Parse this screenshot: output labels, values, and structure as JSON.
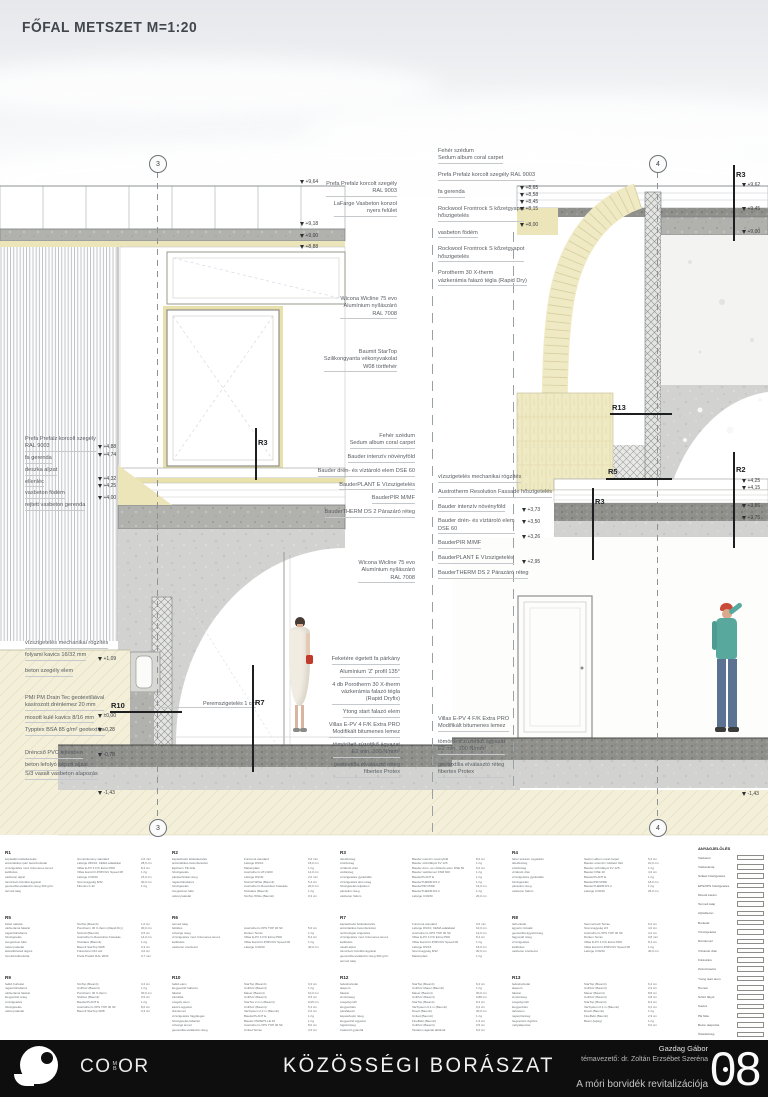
{
  "title": "FŐFAL METSZET M=1:20",
  "grid": {
    "left": "3",
    "right": "4"
  },
  "misc": {
    "perem": "Peremszigetelés 1 cm"
  },
  "rlabels": {
    "r2": "R2",
    "r3": "R3",
    "r5": "R5",
    "r7": "R7",
    "r10": "R10",
    "r13": "R13"
  },
  "elev": {
    "lt": [
      "+9,64",
      "+9,18",
      "+9,00",
      "+8,88"
    ],
    "lm": [
      "+4,88",
      "+4,74",
      "+4,32",
      "+4,25",
      "+4,00"
    ],
    "lb": [
      "+1,09",
      "±0,00",
      "-0,28",
      "-0,78",
      "-1,43"
    ],
    "gt": [
      "+8,65",
      "+8,58",
      "+8,45",
      "+8,15",
      "+8,00"
    ],
    "rm": [
      "+3,73",
      "+3,50",
      "+3,26",
      "+2,95"
    ],
    "re": [
      "+9,62",
      "+9,45",
      "+9,00",
      "+4,25",
      "+4,15",
      "+3,86",
      "+3,75",
      "-1,43"
    ]
  },
  "ann": {
    "gap_left_top": [
      "Prefa Prefalz korcolt szegély\nRAL 9003",
      "LaFarge Vasbeton konzol\nnyers felület"
    ],
    "gap_left_win": [
      "Wicona Wicline 75 evo\nAlumínium nyílászáró\nRAL 7008"
    ],
    "gap_left_vakolat": [
      "Baumit StarTop\nSzilikongyanta vékonyvakolat\nW08 törtfehér"
    ],
    "gap_right_top": [
      "Fehér szédum\nSedum album coral carpet",
      "Prefa Prefalz korcolt szegély RAL 9003",
      "fa gerenda",
      "Rockwool Frontrock S kőzetgyapot\nhőszigetelés",
      "vasbeton födém",
      "Rockwool Frontrock S kőzetgyapot\nhőszigetelés",
      "Porotherm 30 X-therm\nvázkerámia falazó tégla (Rapid Dry)"
    ],
    "gap_left_mid": [
      "Fehér szédum\nSedum album coral carpet",
      "Bauder intenzív növényföld",
      "Bauder drén- és víztároló elem DSE 60",
      "BauderPLANT E Vízszigetelés",
      "BauderPIR M/MF",
      "BauderTHERM DS 2 Párazáró réteg"
    ],
    "gap_left_window2": [
      "Wicona Wicline 75 evo\nAlumínium nyílászáró\nRAL 7008"
    ],
    "gap_right_mid": [
      "vízszigetelés mechanikai rögzítés",
      "Austrotherm Resolution Fassade hőszigetelés",
      "Bauder intenzív növényföld",
      "Bauder drén- és víztároló elem\nDSE 60",
      "BauderPIR M/MF",
      "BauderPLANT E Vízszigetelés",
      "BauderTHERM DS 2 Párazáró réteg"
    ],
    "left_mid": [
      "Prefa Prefalz korcolt szegély\nRAL 9003",
      "fa gerenda",
      "deszka aljzat",
      "ellenléc",
      "vasbeton födém",
      "rejtett vasbeton gerenda"
    ],
    "left_bottom_a": [
      "vízszigetelés mechanikai rögzítés",
      "folyami kavics 16/32 mm"
    ],
    "left_bottom_b": [
      "beton szegély elem"
    ],
    "left_bottom_c": [
      "PMI PM Drain Tec geotextíliával\nkasírozott drénlemez 20 mm",
      "mosott kulé kavics 8/16 mm",
      "Typptex BSA 85 g/m² geotextília"
    ],
    "left_bottom_d": [
      "Dréncső PVC lejtésben",
      "beton lefolyó képző aljzat"
    ],
    "left_bottom_e": [
      "S/3 vasalt vasbeton alapozás"
    ],
    "center_bottom": [
      "Feketére égetett fa párkány",
      "Alumínium 'Z' profil 135°",
      "4 db Porotherm 30 X-therm\nvázkerámia falazó tégla\n(Rapid Dryfix)",
      "Ytong start falazó elem",
      "Villas E-PV 4 F/K Extra PRO\nModifikált bitumenes lemez",
      "tömörített zúzottkő ágyazat\nE2 min. 100 N/mm²",
      "geotextília elválasztó réteg\nfibertex Protex"
    ],
    "right_bottom": [
      "Villas E-PV 4 F/K Extra PRO\nModifikált bitumenes lemez",
      "tömörített zúzottkő ágyazat\nE2 min. 100 N/mm²",
      "geotextília elválasztó réteg\nfibertex Protex"
    ]
  },
  "legend": {
    "blocks": [
      {
        "id": "R1",
        "rows": [
          [
            "kopásálló felületkezelés",
            "Gumiőrlemény standard",
            "2,0 mm"
          ],
          [
            "antisztatikus ipari betonburkolat",
            "Lafarge 250/10, KEMA adalékkal",
            "28,5 cm"
          ],
          [
            "vízszigetelés mod. bitumenes lemez",
            "Villas E-PV 4 F/K Extra PRO",
            "8,4 cm"
          ],
          [
            "kellősítés",
            "Villas EuroCO-P/MV/GV Speed 08",
            "1 rtg"
          ],
          [
            "vasbeton aljzat",
            "Lafarge C30/40",
            "15,0 cm"
          ],
          [
            "tömörített zúzottkő ágyazat",
            "Szemnagyság 8/32",
            "30,0 cm"
          ],
          [
            "geotextília elválasztó réteg 300 g/m²",
            "Fibertex F-32",
            "1 rtg"
          ],
          [
            "termett talaj",
            "",
            ""
          ]
        ]
      },
      {
        "id": "R2",
        "rows": [
          [
            "kapaszkodó felületkezelés",
            "Funciona standard",
            "0,6 mm"
          ],
          [
            "antisztatikus betonburkolat",
            "Lafarge DS/10",
            "18,0 cm"
          ],
          [
            "Ejotherm PE fólia",
            "Masterplast",
            "1 rtg"
          ],
          [
            "hőszigetelés",
            "Austrotherm AT-N100",
            "12,0 cm"
          ],
          [
            "páratechnikai réteg",
            "Lafarge DS/40",
            "2,0 mm"
          ],
          [
            "ragasztóhabarcs",
            "StoColl White (Baumit)",
            "5,4 cm"
          ],
          [
            "hőszigetelés",
            "Austrotherm Resolution Fassade",
            "20,0 cm"
          ],
          [
            "üvegszövet háló",
            "StoGlass (Baumit)",
            "1 rtg"
          ],
          [
            "vékonyvakolat",
            "StoTop White (Baumit)",
            "0,3 cm"
          ]
        ]
      },
      {
        "id": "R3",
        "rows": [
          [
            "ültetőközeg",
            "Bauder intenzív növényföld",
            "8,0 cm"
          ],
          [
            "szűrőréteg",
            "Bauder szűrőfátyol FV 125",
            "1 rtg"
          ],
          [
            "víztároló drén",
            "Bauder drén- és víztároló elem DSE 60",
            "6,0 cm"
          ],
          [
            "védőréteg",
            "Bauder védőlemez FSM 600",
            "1 rtg"
          ],
          [
            "vízszigetelés gyökérálló",
            "BauderPLANT E",
            "1 rtg"
          ],
          [
            "vízszigetelés alsó réteg",
            "BauderTHERM DS 2",
            "1 rtg"
          ],
          [
            "hőszigetelés lejtésben",
            "BauderPIR M/MF",
            "16,0 cm"
          ],
          [
            "párazáró réteg",
            "BauderTHERM DS 2",
            "1 rtg"
          ],
          [
            "vasbeton födém",
            "Lafarge C30/40",
            "20,0 cm"
          ]
        ]
      },
      {
        "id": "R4",
        "rows": [
          [
            "fehér szédum vegetáció",
            "Sedum album coral carpet",
            "5,2 cm"
          ],
          [
            "ültetőközeg",
            "Bauder extenzív zöldtető föld",
            "10,0 cm"
          ],
          [
            "szűrőréteg",
            "Bauder szűrőfátyol FV 125",
            "1 rtg"
          ],
          [
            "víztároló drén",
            "Bauder DSE 40",
            "4,0 cm"
          ],
          [
            "vízszigetelés gyökérálló",
            "BauderPLANT E",
            "1 rtg"
          ],
          [
            "hőszigetelés",
            "BauderPIR M/MF",
            "18,0 cm"
          ],
          [
            "párazáró réteg",
            "BauderTHERM DS 2",
            "1 rtg"
          ],
          [
            "vasbeton födém",
            "Lafarge C30/40",
            "25,0 cm"
          ]
        ]
      },
      {
        "id": "R5",
        "rows": [
          [
            "belső vakolat",
            "StoTop (Baumit)",
            "1,0 cm"
          ],
          [
            "vázkerámia falazat",
            "Porotherm 30 X-therm (Rapid Dry)",
            "30,0 cm"
          ],
          [
            "ragasztóhabarcs",
            "StoColl (Baumit)",
            "0,5 cm"
          ],
          [
            "hőszigetelés",
            "Austrotherm Resolution Fassade",
            "14,0 cm"
          ],
          [
            "üvegszövet háló",
            "StoGlass (Baumit)",
            "1 rtg"
          ],
          [
            "vékonyvakolat",
            "Baumit StarTop W08",
            "0,3 cm"
          ],
          [
            "átszellőztetett légrés",
            "Fűrészáru C24 váz",
            "4,0 cm"
          ],
          [
            "homlokzatburkolat",
            "Prefa Prefalz RAL 9003",
            "0,7 mm"
          ]
        ]
      },
      {
        "id": "R6",
        "rows": [
          [
            "termett talaj",
            "",
            ""
          ],
          [
            "feltöltés",
            "Austrotherm XPS TOP 30 SF",
            "5,0 cm"
          ],
          [
            "szivárgó réteg",
            "Dörken Terrax",
            "1 rtg"
          ],
          [
            "vízszigetelés mod. bitumenes lemez",
            "Villas E-PV 4 F/K Extra PRO",
            "8,4 cm"
          ],
          [
            "kellősítés",
            "Villas EuroCO-P/MV/GV Speed 08",
            "1 rtg"
          ],
          [
            "vasbeton szerkezet",
            "Lafarge C30/40",
            "40,0 cm"
          ]
        ]
      },
      {
        "id": "R7",
        "rows": [
          [
            "kapaszkodó felületkezelés",
            "Funciona standard",
            "0,6 mm"
          ],
          [
            "antisztatikus betonburkolat",
            "Lafarge DS/10, KEMA adalékkal",
            "10,0 cm"
          ],
          [
            "technológiai szigetelés",
            "Austrotherm XPS TOP 30 SF",
            "12,0 cm"
          ],
          [
            "vízszigetelés mod. bitumenes lemez",
            "Villas E-PV 4 F/K Extra PRO",
            "8,4 cm"
          ],
          [
            "kellősítés",
            "Villas EuroCO-P/MV/GV Speed 08",
            "1 rtg"
          ],
          [
            "vasalt aljzat",
            "Lafarge DS/16",
            "18,0 cm"
          ],
          [
            "tömörített zúzottkő ágyazat",
            "Szemnagyság 8/32",
            "30,0 cm"
          ],
          [
            "geotextília elválasztó réteg 300 g/m²",
            "Masterplast",
            "1 rtg"
          ],
          [
            "termett talaj",
            "",
            ""
          ]
        ]
      },
      {
        "id": "R8",
        "rows": [
          [
            "térburkolat",
            "Semmelrock Terrae",
            "6,0 cm"
          ],
          [
            "ágyazó zúzalék",
            "Szemnagyság 2/4",
            "4,0 cm"
          ],
          [
            "geotextília ágyazóréteg",
            "Austrotherm XPS TOP 30 SF",
            "3,2 cm"
          ],
          [
            "fagyvédő réteg",
            "Dörken Terrax",
            "0,8 mm"
          ],
          [
            "vízszigetelés",
            "Villas E-PV 4 F/K Extra PRO",
            "8,4 cm"
          ],
          [
            "kellősítés",
            "Villas EuroCO-P/MV/GV Speed 08",
            "1 rtg"
          ],
          [
            "vasbeton szerkezet",
            "Lafarge C30/40",
            "40,0 cm"
          ]
        ]
      },
      {
        "id": "R9",
        "rows": [
          [
            "fedkő burkolat",
            "StoTop (Baumit)",
            "3,2 cm"
          ],
          [
            "ragasztóhabarcs",
            "UniPutz (Baumit)",
            "1 rtg"
          ],
          [
            "vázkerámia falazat",
            "Porotherm 30 X-therm",
            "30,0 cm"
          ],
          [
            "kiegyenlítő réteg",
            "StoFlex (Baumit)",
            "0,5 cm"
          ],
          [
            "vízszigetelés",
            "BauderPLANT E",
            "1 rtg"
          ],
          [
            "hőszigetelés",
            "Austrotherm XPS TOP 30 SF",
            "8,0 cm"
          ],
          [
            "vékonyvakolat",
            "Baumit StarTop W08",
            "0,3 cm"
          ]
        ]
      },
      {
        "id": "R10",
        "rows": [
          [
            "fedkő elem",
            "StarTop (Baumit)",
            "3,2 cm"
          ],
          [
            "kiegyenlítő habarcs",
            "UniPutz (Baumit)",
            "1 rtg"
          ],
          [
            "falazat",
            "Mauer (Baumit)",
            "10,0 cm"
          ],
          [
            "zárófólia",
            "UniPutz (Baumit)",
            "0,5 cm"
          ],
          [
            "szegély elem",
            "StarTex 2 mm (Baumit)",
            "0,05 cm"
          ],
          [
            "kavics ágyazat",
            "UniPutz (Baumit)",
            "5,4 cm"
          ],
          [
            "drénlemez",
            "VarSystem 2,4 m (Baumit)",
            "0,2 cm"
          ],
          [
            "vízszigetelés függőleges",
            "BauderPLANT E",
            "1 rtg"
          ],
          [
            "hőszigetelés lábazati",
            "Bauder PIR/EPS LE 20",
            "1 rtg"
          ],
          [
            "szivárgó lemez",
            "Austrotherm XPS TOP 30 SF",
            "8,0 cm"
          ],
          [
            "geotextília elválasztó réteg",
            "United Terrae",
            "3,2 cm"
          ]
        ]
      },
      {
        "id": "R12",
        "rows": [
          [
            "fedésburkolat",
            "StarTop (Baumit)",
            "6,2 cm"
          ],
          [
            "alapozó",
            "UniPutz Mauer (Baumit)",
            "1 rtg"
          ],
          [
            "falazat",
            "Mauer (Baumit)",
            "30,0 cm"
          ],
          [
            "simítóréteg",
            "UniPutz (Baumit)",
            "0,88 cm"
          ],
          [
            "szegélyprofil",
            "StarTop (Baumit)",
            "8,4 cm"
          ],
          [
            "kiegyenlítés",
            "VarSystem 0,4 m (Baumit)",
            "0,2 cm"
          ],
          [
            "párafékező",
            "Dravit (Baumit)",
            "30,0 cm"
          ],
          [
            "kapaszkodó réteg",
            "United (Baumit)",
            "1 rtg"
          ],
          [
            "kiegyenlítő ágyazat",
            "FineBelő (Baumit)",
            "1,5 cm"
          ],
          [
            "fugázóréteg",
            "UniPutz (Baumit)",
            "0,5 cm"
          ],
          [
            "zsaluzott gyámfal",
            "Tartalom ágazati táblázat",
            "6,0 cm"
          ]
        ]
      },
      {
        "id": "R13",
        "rows": [
          [
            "fedésburkolat",
            "StarTop (Baumit)",
            "6,2 cm"
          ],
          [
            "alapozó",
            "UniPutz (Baumit)",
            "2,9 cm"
          ],
          [
            "falazat",
            "Mauer (Baumit)",
            "8,8 cm"
          ],
          [
            "simítóréteg",
            "UniPutz (Baumit)",
            "0,8 cm"
          ],
          [
            "szegélyprofil",
            "StarTop (Baumit)",
            "8,4 cm"
          ],
          [
            "kiegyenlítés",
            "VarSystem 0,4 m (Baumit)",
            "0,2 cm"
          ],
          [
            "tartóelem",
            "Dravit (Baumit)",
            "1 rtg"
          ],
          [
            "ragasztóréteg",
            "FineBelő (Baumit)",
            "2,9 cm"
          ],
          [
            "hegesztett rögzítés",
            "Beton (lejtég)",
            "1 rtg"
          ],
          [
            "mélyalapozás",
            "",
            "6,0 cm"
          ]
        ]
      }
    ],
    "materials": {
      "title": "ANYAGJELÖLÉS",
      "items": [
        {
          "label": "Vasbeton",
          "sw": "concrete"
        },
        {
          "label": "Vázkerámia",
          "sw": "cross"
        },
        {
          "label": "Szálas hőszigetelés",
          "sw": "wave"
        },
        {
          "label": "EPS/XPS hőszigetelés",
          "sw": "wave2"
        },
        {
          "label": "Mosott kavics",
          "sw": "lightgray"
        },
        {
          "label": "Termett talaj",
          "sw": "soil"
        },
        {
          "label": "Aljzatbeton",
          "sw": "gray"
        },
        {
          "label": "Burkolat",
          "sw": "white"
        },
        {
          "label": "Vízszigetelés",
          "sw": "darkline"
        },
        {
          "label": "Drénlemez",
          "sw": "dots"
        },
        {
          "label": "Víztároló drén",
          "sw": "dashes"
        },
        {
          "label": "Fűrészáru",
          "sw": "white"
        },
        {
          "label": "Zúzott kavics",
          "sw": "gravel"
        },
        {
          "label": "Ytong start elem",
          "sw": "white"
        },
        {
          "label": "Homok",
          "sw": "white"
        },
        {
          "label": "Szűrő fátyol",
          "sw": "dashes"
        },
        {
          "label": "Kavics",
          "sw": "lightgray"
        },
        {
          "label": "PE fólia",
          "sw": "dark"
        },
        {
          "label": "Beton alapozás",
          "sw": "speckle"
        },
        {
          "label": "Ültetőközeg",
          "sw": "white"
        },
        {
          "label": "PIR hőszigetelés",
          "sw": "lightgray"
        }
      ]
    }
  },
  "footer": {
    "studio": {
      "pre": "CO",
      "top": "M",
      "bottom": "B",
      "post": "OR"
    },
    "project_title": "KÖZÖSSÉGI BORÁSZAT",
    "author": "Gazdag Gábor",
    "supervisor": "témavezető: dr. Zoltán Erzsébet Szeréna",
    "subtitle": "A móri borvidék revitalizációja",
    "page_number": "08"
  }
}
